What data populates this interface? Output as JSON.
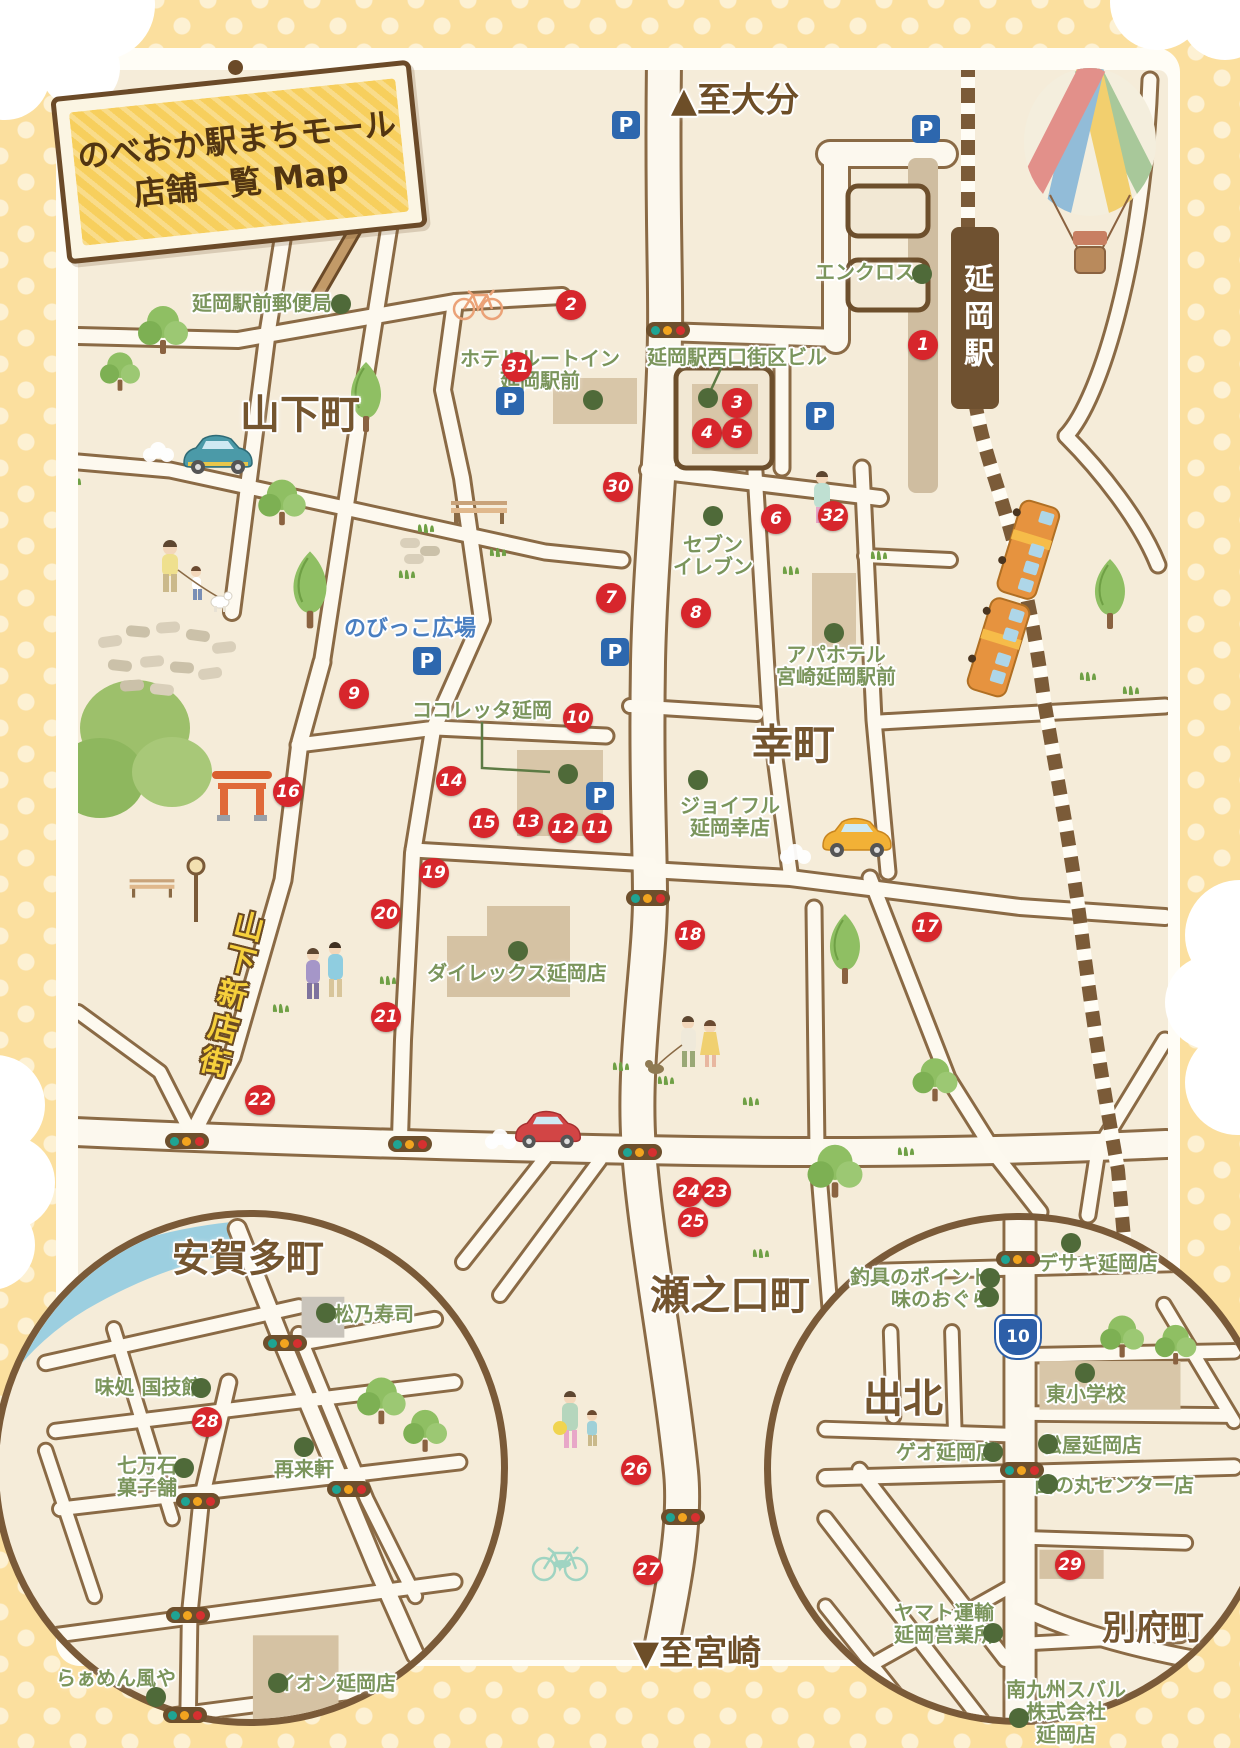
{
  "title": {
    "line1": "のべおか駅まちモール",
    "line2": "店舗一覧 Map"
  },
  "directions": {
    "to_oita": "▲至大分",
    "to_miyazaki": "▼至宮崎"
  },
  "station": {
    "name": "延岡駅"
  },
  "route_shield": {
    "number": "10"
  },
  "street_sign": {
    "label": "山下新店街"
  },
  "districts": [
    {
      "id": "yamashita",
      "label": "山下町",
      "x": 300,
      "y": 411,
      "size": 40
    },
    {
      "id": "saiwai",
      "label": "幸町",
      "x": 793,
      "y": 742,
      "size": 42
    },
    {
      "id": "senokuchi",
      "label": "瀬之口町",
      "x": 730,
      "y": 1292,
      "size": 40
    },
    {
      "id": "agata",
      "label": "安賀多町",
      "x": 248,
      "y": 1255,
      "size": 38
    },
    {
      "id": "idekita",
      "label": "出北",
      "x": 903,
      "y": 1395,
      "size": 40
    },
    {
      "id": "beppu",
      "label": "別府町",
      "x": 1153,
      "y": 1625,
      "size": 34
    }
  ],
  "places": [
    {
      "lines": [
        "延岡駅前郵便局"
      ],
      "x": 262,
      "y": 303,
      "dot": {
        "x": 341,
        "y": 304
      }
    },
    {
      "lines": [
        "エンクロス"
      ],
      "x": 865,
      "y": 272,
      "dot": {
        "x": 922,
        "y": 274
      }
    },
    {
      "lines": [
        "ホテルルートイン",
        "延岡駅前"
      ],
      "x": 540,
      "y": 370,
      "dot": {
        "x": 593,
        "y": 400
      }
    },
    {
      "lines": [
        "延岡駅西口街区ビル"
      ],
      "x": 737,
      "y": 357,
      "dot": {
        "x": 708,
        "y": 398
      }
    },
    {
      "lines": [
        "セブン",
        "イレブン"
      ],
      "x": 713,
      "y": 556,
      "dot": {
        "x": 713,
        "y": 516
      }
    },
    {
      "lines": [
        "アパホテル",
        "宮崎延岡駅前"
      ],
      "x": 836,
      "y": 666,
      "dot": {
        "x": 834,
        "y": 633
      }
    },
    {
      "lines": [
        "のびっこ広場"
      ],
      "x": 410,
      "y": 630,
      "dot": null,
      "color": "blue"
    },
    {
      "lines": [
        "ココレッタ延岡"
      ],
      "x": 482,
      "y": 710,
      "dot": {
        "x": 568,
        "y": 774
      }
    },
    {
      "lines": [
        "ジョイフル",
        "延岡幸店"
      ],
      "x": 730,
      "y": 817,
      "dot": {
        "x": 698,
        "y": 780
      }
    },
    {
      "lines": [
        "ダイレックス延岡店"
      ],
      "x": 517,
      "y": 973,
      "dot": {
        "x": 518,
        "y": 951
      }
    },
    {
      "lines": [
        "松乃寿司"
      ],
      "x": 374,
      "y": 1314,
      "dot": {
        "x": 326,
        "y": 1313
      }
    },
    {
      "lines": [
        "味処 国技館"
      ],
      "x": 148,
      "y": 1387,
      "dot": {
        "x": 201,
        "y": 1388
      }
    },
    {
      "lines": [
        "七万石",
        "菓子舗"
      ],
      "x": 147,
      "y": 1477,
      "dot": {
        "x": 184,
        "y": 1468
      }
    },
    {
      "lines": [
        "再来軒"
      ],
      "x": 304,
      "y": 1469,
      "dot": {
        "x": 304,
        "y": 1447
      }
    },
    {
      "lines": [
        "らぁめん風や"
      ],
      "x": 116,
      "y": 1678,
      "dot": {
        "x": 156,
        "y": 1697
      }
    },
    {
      "lines": [
        "イオン延岡店"
      ],
      "x": 336,
      "y": 1683,
      "dot": {
        "x": 278,
        "y": 1683
      }
    },
    {
      "lines": [
        "釣具のポイント"
      ],
      "x": 920,
      "y": 1277,
      "dot": {
        "x": 990,
        "y": 1278
      }
    },
    {
      "lines": [
        "味のおぐら"
      ],
      "x": 941,
      "y": 1299,
      "dot": {
        "x": 989,
        "y": 1297
      }
    },
    {
      "lines": [
        "デサキ延岡店"
      ],
      "x": 1098,
      "y": 1263,
      "dot": {
        "x": 1071,
        "y": 1243
      }
    },
    {
      "lines": [
        "東小学校"
      ],
      "x": 1086,
      "y": 1394,
      "dot": {
        "x": 1085,
        "y": 1373
      }
    },
    {
      "lines": [
        "ゲオ延岡店"
      ],
      "x": 946,
      "y": 1452,
      "dot": {
        "x": 993,
        "y": 1452
      }
    },
    {
      "lines": [
        "松屋延岡店"
      ],
      "x": 1092,
      "y": 1445,
      "dot": {
        "x": 1048,
        "y": 1444
      }
    },
    {
      "lines": [
        "西の丸センター店"
      ],
      "x": 1114,
      "y": 1485,
      "dot": {
        "x": 1048,
        "y": 1484
      }
    },
    {
      "lines": [
        "ヤマト運輸",
        "延岡営業所"
      ],
      "x": 944,
      "y": 1624,
      "dot": {
        "x": 993,
        "y": 1633
      }
    },
    {
      "lines": [
        "南九州スバル",
        "株式会社",
        "延岡店"
      ],
      "x": 1066,
      "y": 1712,
      "dot": {
        "x": 1019,
        "y": 1718
      }
    }
  ],
  "markers": [
    {
      "n": 1,
      "x": 923,
      "y": 345
    },
    {
      "n": 2,
      "x": 571,
      "y": 305
    },
    {
      "n": 3,
      "x": 737,
      "y": 403
    },
    {
      "n": 4,
      "x": 707,
      "y": 433
    },
    {
      "n": 5,
      "x": 737,
      "y": 433
    },
    {
      "n": 6,
      "x": 776,
      "y": 519
    },
    {
      "n": 7,
      "x": 611,
      "y": 598
    },
    {
      "n": 8,
      "x": 696,
      "y": 613
    },
    {
      "n": 9,
      "x": 354,
      "y": 694
    },
    {
      "n": 10,
      "x": 578,
      "y": 718
    },
    {
      "n": 11,
      "x": 597,
      "y": 828
    },
    {
      "n": 12,
      "x": 563,
      "y": 828
    },
    {
      "n": 13,
      "x": 528,
      "y": 822
    },
    {
      "n": 14,
      "x": 451,
      "y": 781
    },
    {
      "n": 15,
      "x": 484,
      "y": 823
    },
    {
      "n": 16,
      "x": 288,
      "y": 792
    },
    {
      "n": 17,
      "x": 927,
      "y": 927
    },
    {
      "n": 18,
      "x": 690,
      "y": 935
    },
    {
      "n": 19,
      "x": 434,
      "y": 873
    },
    {
      "n": 20,
      "x": 386,
      "y": 914
    },
    {
      "n": 21,
      "x": 386,
      "y": 1017
    },
    {
      "n": 22,
      "x": 260,
      "y": 1100
    },
    {
      "n": 23,
      "x": 716,
      "y": 1192
    },
    {
      "n": 24,
      "x": 688,
      "y": 1192
    },
    {
      "n": 25,
      "x": 693,
      "y": 1222
    },
    {
      "n": 26,
      "x": 636,
      "y": 1470
    },
    {
      "n": 27,
      "x": 648,
      "y": 1570
    },
    {
      "n": 28,
      "x": 207,
      "y": 1422
    },
    {
      "n": 29,
      "x": 1070,
      "y": 1565
    },
    {
      "n": 30,
      "x": 618,
      "y": 487
    },
    {
      "n": 31,
      "x": 517,
      "y": 367
    },
    {
      "n": 32,
      "x": 833,
      "y": 516
    }
  ],
  "parking": {
    "label": "P",
    "spots": [
      {
        "x": 626,
        "y": 125
      },
      {
        "x": 926,
        "y": 129
      },
      {
        "x": 510,
        "y": 401
      },
      {
        "x": 820,
        "y": 416
      },
      {
        "x": 427,
        "y": 661
      },
      {
        "x": 615,
        "y": 652
      },
      {
        "x": 600,
        "y": 796
      }
    ]
  },
  "traffic_lights": [
    {
      "x": 668,
      "y": 330
    },
    {
      "x": 648,
      "y": 898
    },
    {
      "x": 187,
      "y": 1141
    },
    {
      "x": 410,
      "y": 1144
    },
    {
      "x": 640,
      "y": 1152
    },
    {
      "x": 683,
      "y": 1517
    },
    {
      "x": 285,
      "y": 1343
    },
    {
      "x": 198,
      "y": 1501
    },
    {
      "x": 349,
      "y": 1489
    },
    {
      "x": 188,
      "y": 1615
    },
    {
      "x": 185,
      "y": 1715
    },
    {
      "x": 1018,
      "y": 1259
    },
    {
      "x": 1022,
      "y": 1470
    }
  ],
  "colors": {
    "marker_red": "#d7262c",
    "dot_green": "#4f6a39",
    "label_green": "#7b955c",
    "label_brown": "#74552f",
    "label_blue": "#4a7fc1",
    "parking_blue": "#2d67ae",
    "road_outline": "#8a6a45",
    "map_bg": "#f5ecd9",
    "border_yellow": "#fbdf9e",
    "sign_yellow": "#f7cf5d",
    "station_brown": "#6f5130",
    "railway_brown": "#7b5b38",
    "river_blue": "#9ccfe0",
    "route_shield_blue": "#2d5fa8"
  }
}
